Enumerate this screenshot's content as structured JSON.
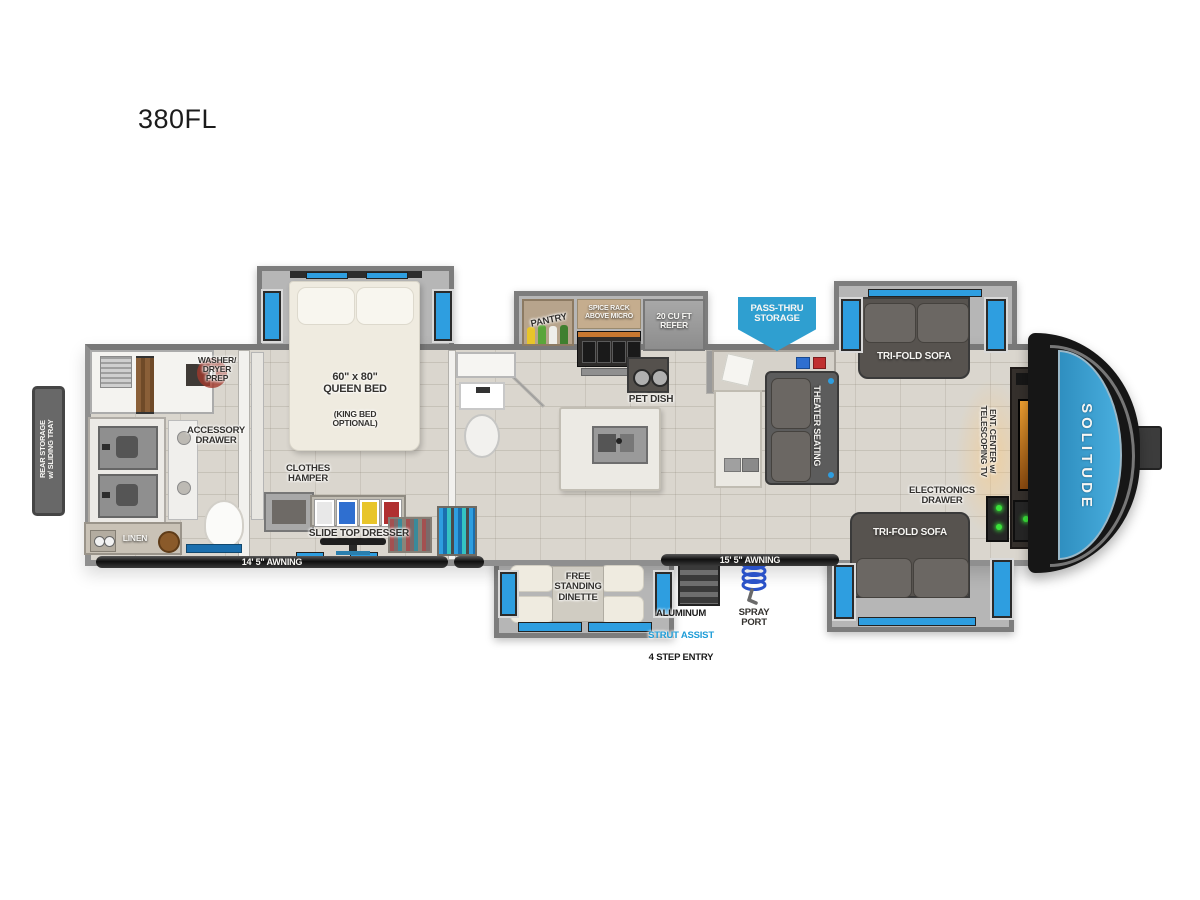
{
  "page": {
    "model": "380FL"
  },
  "brand": {
    "name": "SOLITUDE"
  },
  "colors": {
    "accent_blue": "#2f9fd0",
    "window_blue": "#2e9ee0",
    "strut_text_blue": "#1e9cd7",
    "front_cap_blue": "#3a9cce",
    "awning_bar": "#1c1c1c"
  },
  "exterior": {
    "rear_storage": "REAR STORAGE\nw/ SLIDING TRAY",
    "awning_left": "14' 5\" AWNING",
    "awning_right": "15' 5\" AWNING",
    "pass_thru": "PASS-THRU\nSTORAGE",
    "entry": {
      "line1": "ALUMINUM",
      "line2": "STRUT ASSIST",
      "line3": "4 STEP ENTRY"
    },
    "spray_port": "SPRAY\nPORT"
  },
  "bathroom": {
    "washer_dryer": "WASHER/\nDRYER\nPREP",
    "accessory_drawer": "ACCESSORY\nDRAWER",
    "linen": "LINEN"
  },
  "bedroom": {
    "bed_size": "60\" x 80\"\nQUEEN BED",
    "bed_option": "(KING BED\nOPTIONAL)",
    "clothes_hamper": "CLOTHES\nHAMPER",
    "slide_top_dresser": "SLIDE TOP DRESSER"
  },
  "kitchen": {
    "pantry": "PANTRY",
    "spice_rack": "SPICE RACK\nABOVE MICRO",
    "refer": "20 CU FT\nREFER",
    "pet_dish": "PET DISH"
  },
  "living": {
    "theater_seating": "THEATER SEATING",
    "sofa_top": "TRI-FOLD SOFA",
    "sofa_bottom": "TRI-FOLD SOFA",
    "electronics_drawer": "ELECTRONICS\nDRAWER",
    "ent_center": "ENT. CENTER w/\nTELESCOPING TV",
    "dinette": "FREE\nSTANDING\nDINETTE"
  }
}
